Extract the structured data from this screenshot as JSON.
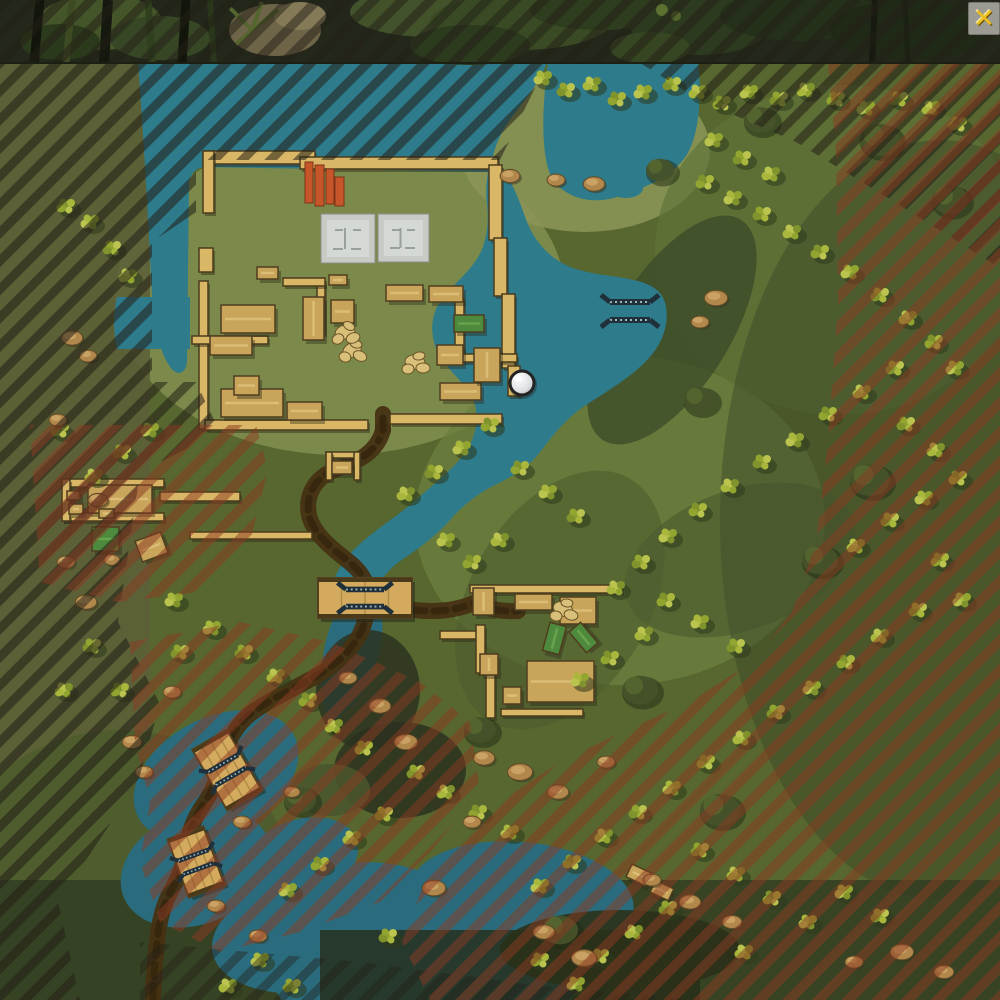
{
  "window": {
    "close_label": "✕"
  },
  "map": {
    "description": "top-down jungle river battle map with two compounds, bridges and out-of-bounds hatching",
    "colors": {
      "water": "#2e7b8c",
      "water_deep": "#2a6c7d",
      "terrain": "#57672f",
      "field": "#7d8c4c",
      "wall": "#d9b767",
      "building": "#c8a55b",
      "building_light": "#e0c27b",
      "green_building": "#4d8a3d",
      "road": "#463213",
      "road_dark": "#33240d",
      "bridge": "#d4ab5e",
      "hatch_dark": "#221f16",
      "hatch_red": "#8c3a21",
      "icon": "#20303a",
      "pad": "#c6cbc6",
      "container": "#c65629",
      "rock": "#b1874b",
      "canopy": "#46532a",
      "close_bg": "#a3a29a",
      "close_x": "#f6c81e"
    },
    "tree_colors": [
      "#a9b73d",
      "#93a531",
      "#bac44f",
      "#80932c"
    ],
    "markers": {
      "control_point": {
        "x": 522,
        "y": 383,
        "r": 12
      },
      "bridge_icons": [
        {
          "x": 630,
          "y": 311,
          "rot": 0,
          "s": 1
        },
        {
          "x": 365,
          "y": 598,
          "rot": 0,
          "s": 0.95
        },
        {
          "x": 227,
          "y": 770,
          "rot": -30,
          "s": 0.85
        },
        {
          "x": 196,
          "y": 862,
          "rot": -20,
          "s": 0.8
        }
      ]
    },
    "features": {
      "bridges": [
        {
          "x": 365,
          "y": 598,
          "w": 94,
          "h": 40,
          "rot": 0
        },
        {
          "x": 227,
          "y": 770,
          "w": 40,
          "h": 70,
          "rot": -30
        },
        {
          "x": 196,
          "y": 862,
          "w": 38,
          "h": 62,
          "rot": -20
        }
      ],
      "roads": [
        "M383,430 C377,452 359,461 337,469 C315,477 305,495 309,515 C313,533 330,547 348,561 C361,571 367,581 368,593",
        "M368,604 C366,622 362,633 353,645 C343,659 329,669 311,679 C289,691 267,701 249,715 C235,727 227,743 223,759 C219,775 213,791 203,805 C195,817 189,831 187,845 C185,861 179,877 171,891 C163,905 159,923 157,941 C155,961 153,981 153,1000",
        "M372,601 C392,607 412,611 432,611 C448,611 462,608 474,603",
        "M474,603 C488,609 502,612 518,611",
        "M383,430 L383,414"
      ],
      "walls": [
        [
          203,
          151,
          112,
          13
        ],
        [
          300,
          157,
          198,
          12
        ],
        [
          489,
          165,
          13,
          75
        ],
        [
          494,
          238,
          13,
          58
        ],
        [
          502,
          294,
          13,
          74
        ],
        [
          508,
          366,
          12,
          30
        ],
        [
          203,
          151,
          11,
          62
        ],
        [
          199,
          248,
          14,
          24
        ],
        [
          199,
          281,
          9,
          148
        ],
        [
          205,
          420,
          163,
          10
        ],
        [
          390,
          414,
          112,
          10
        ],
        [
          317,
          282,
          8,
          52
        ],
        [
          192,
          336,
          76,
          8
        ],
        [
          283,
          278,
          42,
          8
        ],
        [
          455,
          299,
          9,
          60
        ],
        [
          462,
          354,
          55,
          8
        ],
        [
          326,
          452,
          34,
          6
        ],
        [
          326,
          452,
          6,
          28
        ],
        [
          354,
          452,
          6,
          28
        ],
        [
          470,
          585,
          152,
          8
        ],
        [
          440,
          631,
          38,
          8
        ],
        [
          476,
          625,
          9,
          48
        ],
        [
          486,
          670,
          9,
          48
        ],
        [
          501,
          709,
          82,
          7
        ],
        [
          62,
          479,
          102,
          8
        ],
        [
          62,
          513,
          102,
          8
        ],
        [
          62,
          479,
          8,
          42
        ],
        [
          160,
          492,
          80,
          9
        ],
        [
          190,
          532,
          122,
          7
        ]
      ],
      "buildings": [
        [
          221,
          305,
          54,
          28,
          0
        ],
        [
          210,
          336,
          42,
          19,
          0
        ],
        [
          221,
          389,
          62,
          28,
          0
        ],
        [
          287,
          402,
          35,
          18,
          0
        ],
        [
          303,
          297,
          21,
          43,
          0
        ],
        [
          331,
          300,
          23,
          23,
          0
        ],
        [
          386,
          285,
          37,
          16,
          0
        ],
        [
          429,
          286,
          34,
          16,
          0
        ],
        [
          440,
          383,
          41,
          17,
          0
        ],
        [
          474,
          348,
          26,
          34,
          0
        ],
        [
          437,
          345,
          26,
          20,
          0
        ],
        [
          257,
          267,
          21,
          12,
          0
        ],
        [
          329,
          275,
          18,
          10,
          0
        ],
        [
          234,
          376,
          25,
          19,
          0
        ],
        [
          332,
          461,
          20,
          13,
          0
        ],
        [
          473,
          588,
          21,
          27,
          0
        ],
        [
          515,
          594,
          37,
          16,
          0
        ],
        [
          560,
          597,
          36,
          27,
          0
        ],
        [
          527,
          661,
          67,
          41,
          0
        ],
        [
          480,
          654,
          18,
          21,
          0
        ],
        [
          503,
          687,
          18,
          17,
          0
        ],
        [
          88,
          485,
          64,
          28,
          0
        ],
        [
          67,
          491,
          13,
          9,
          0
        ],
        [
          69,
          504,
          14,
          10,
          0
        ],
        [
          99,
          509,
          15,
          9,
          0
        ],
        [
          138,
          536,
          27,
          22,
          -20
        ],
        [
          628,
          868,
          22,
          14,
          25
        ],
        [
          652,
          884,
          20,
          13,
          25
        ]
      ],
      "green_buildings": [
        [
          454,
          315,
          30,
          17,
          0
        ],
        [
          546,
          624,
          17,
          29,
          15
        ],
        [
          576,
          624,
          15,
          27,
          -40
        ],
        [
          92,
          527,
          27,
          24,
          0
        ]
      ],
      "pads": [
        [
          321,
          214,
          54,
          49
        ],
        [
          378,
          214,
          51,
          48
        ]
      ],
      "containers": [
        [
          305,
          162,
          8,
          41
        ],
        [
          315,
          165,
          9,
          41
        ],
        [
          326,
          169,
          8,
          35
        ],
        [
          335,
          177,
          9,
          29
        ]
      ],
      "pale_clusters": [
        [
          352,
          350
        ],
        [
          415,
          362
        ],
        [
          345,
          332
        ],
        [
          563,
          609
        ]
      ],
      "trees": [
        [
          543,
          78
        ],
        [
          566,
          90
        ],
        [
          592,
          84
        ],
        [
          617,
          99
        ],
        [
          643,
          92
        ],
        [
          672,
          84
        ],
        [
          698,
          92
        ],
        [
          722,
          103
        ],
        [
          749,
          92
        ],
        [
          779,
          99
        ],
        [
          806,
          90
        ],
        [
          836,
          99
        ],
        [
          866,
          108
        ],
        [
          899,
          99
        ],
        [
          931,
          108
        ],
        [
          958,
          124
        ],
        [
          714,
          140
        ],
        [
          742,
          158
        ],
        [
          771,
          174
        ],
        [
          705,
          182
        ],
        [
          733,
          198
        ],
        [
          762,
          214
        ],
        [
          792,
          232
        ],
        [
          820,
          252
        ],
        [
          850,
          272
        ],
        [
          880,
          295
        ],
        [
          908,
          318
        ],
        [
          934,
          342
        ],
        [
          955,
          368
        ],
        [
          895,
          368
        ],
        [
          862,
          392
        ],
        [
          828,
          414
        ],
        [
          795,
          440
        ],
        [
          762,
          462
        ],
        [
          730,
          486
        ],
        [
          698,
          510
        ],
        [
          668,
          536
        ],
        [
          641,
          562
        ],
        [
          616,
          588
        ],
        [
          666,
          600
        ],
        [
          700,
          622
        ],
        [
          736,
          646
        ],
        [
          644,
          634
        ],
        [
          610,
          658
        ],
        [
          580,
          680
        ],
        [
          906,
          424
        ],
        [
          936,
          450
        ],
        [
          958,
          478
        ],
        [
          924,
          498
        ],
        [
          890,
          520
        ],
        [
          856,
          546
        ],
        [
          940,
          560
        ],
        [
          962,
          600
        ],
        [
          918,
          610
        ],
        [
          880,
          636
        ],
        [
          846,
          662
        ],
        [
          812,
          688
        ],
        [
          776,
          712
        ],
        [
          742,
          738
        ],
        [
          706,
          762
        ],
        [
          672,
          788
        ],
        [
          638,
          812
        ],
        [
          604,
          836
        ],
        [
          572,
          862
        ],
        [
          540,
          886
        ],
        [
          700,
          850
        ],
        [
          736,
          874
        ],
        [
          772,
          898
        ],
        [
          808,
          922
        ],
        [
          668,
          908
        ],
        [
          634,
          932
        ],
        [
          600,
          956
        ],
        [
          844,
          892
        ],
        [
          880,
          916
        ],
        [
          744,
          952
        ],
        [
          490,
          425
        ],
        [
          462,
          448
        ],
        [
          434,
          472
        ],
        [
          406,
          494
        ],
        [
          520,
          468
        ],
        [
          548,
          492
        ],
        [
          576,
          516
        ],
        [
          500,
          540
        ],
        [
          472,
          562
        ],
        [
          446,
          540
        ],
        [
          416,
          772
        ],
        [
          446,
          792
        ],
        [
          478,
          812
        ],
        [
          510,
          832
        ],
        [
          384,
          814
        ],
        [
          352,
          838
        ],
        [
          320,
          864
        ],
        [
          288,
          890
        ],
        [
          244,
          652
        ],
        [
          276,
          676
        ],
        [
          308,
          700
        ],
        [
          212,
          628
        ],
        [
          180,
          652
        ],
        [
          334,
          726
        ],
        [
          364,
          748
        ],
        [
          90,
          222
        ],
        [
          112,
          248
        ],
        [
          128,
          276
        ],
        [
          66,
          206
        ],
        [
          150,
          430
        ],
        [
          122,
          452
        ],
        [
          94,
          476
        ],
        [
          60,
          430
        ],
        [
          174,
          600
        ],
        [
          92,
          646
        ],
        [
          64,
          690
        ],
        [
          120,
          690
        ],
        [
          260,
          960
        ],
        [
          292,
          986
        ],
        [
          228,
          986
        ],
        [
          540,
          960
        ],
        [
          576,
          984
        ],
        [
          388,
          936
        ]
      ],
      "canopy": [
        [
          760,
          120,
          16
        ],
        [
          880,
          140,
          20
        ],
        [
          950,
          200,
          18
        ],
        [
          700,
          400,
          16
        ],
        [
          870,
          480,
          20
        ],
        [
          640,
          690,
          18
        ],
        [
          480,
          730,
          16
        ],
        [
          720,
          810,
          20
        ],
        [
          560,
          930,
          18
        ],
        [
          300,
          800,
          16
        ],
        [
          660,
          170,
          14
        ],
        [
          820,
          560,
          18
        ]
      ],
      "rocks": [
        [
          72,
          338,
          1.2
        ],
        [
          88,
          356,
          1
        ],
        [
          58,
          420,
          1
        ],
        [
          98,
          500,
          1.1
        ],
        [
          66,
          562,
          1
        ],
        [
          86,
          602,
          1.2
        ],
        [
          112,
          560,
          0.9
        ],
        [
          510,
          176,
          1.1
        ],
        [
          556,
          180,
          1
        ],
        [
          594,
          184,
          1.2
        ],
        [
          716,
          298,
          1.3
        ],
        [
          700,
          322,
          1
        ],
        [
          484,
          758,
          1.2
        ],
        [
          520,
          772,
          1.4
        ],
        [
          558,
          792,
          1.2
        ],
        [
          606,
          762,
          1
        ],
        [
          472,
          822,
          1
        ],
        [
          434,
          888,
          1.3
        ],
        [
          652,
          880,
          1
        ],
        [
          690,
          902,
          1.2
        ],
        [
          732,
          922,
          1.1
        ],
        [
          584,
          958,
          1.4
        ],
        [
          544,
          932,
          1.2
        ],
        [
          144,
          772,
          1
        ],
        [
          242,
          822,
          1
        ],
        [
          292,
          792,
          0.9
        ],
        [
          216,
          906,
          1
        ],
        [
          258,
          936,
          1
        ],
        [
          172,
          692,
          1
        ],
        [
          132,
          742,
          1.1
        ],
        [
          902,
          952,
          1.3
        ],
        [
          944,
          972,
          1.1
        ],
        [
          854,
          962,
          1
        ],
        [
          380,
          706,
          1.2
        ],
        [
          348,
          678,
          1
        ],
        [
          406,
          742,
          1.3
        ]
      ]
    }
  }
}
